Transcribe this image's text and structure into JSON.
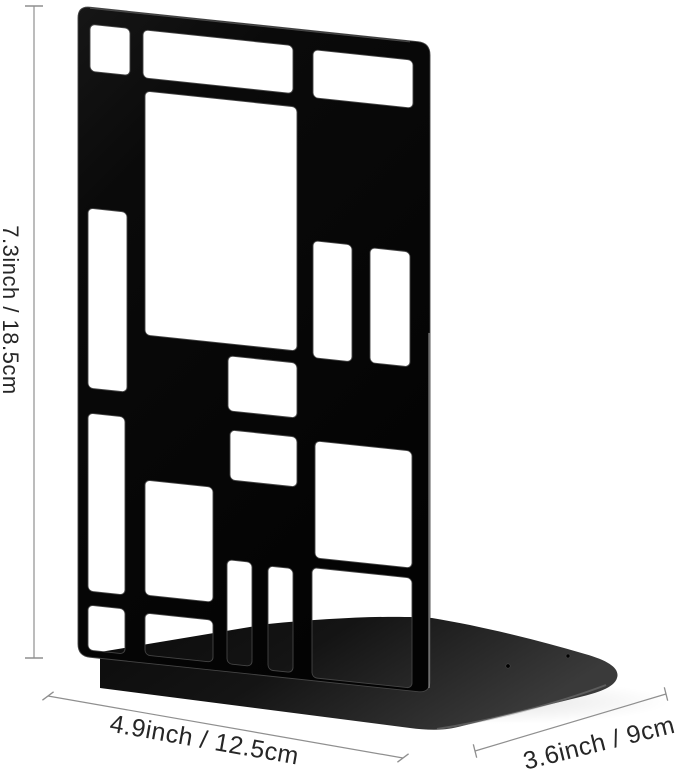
{
  "product": {
    "description": "Black metal bookend with Mondrian-style rectangular grid cutouts standing on an L-shaped base plate"
  },
  "annotations": {
    "height_label": "7.3inch / 18.5cm",
    "width_label": "4.9inch / 12.5cm",
    "depth_label": "3.6inch / 9cm"
  },
  "colors": {
    "panel_black": "#0a0a0a",
    "panel_edge": "#454545",
    "base_dark": "#0d0d0d",
    "base_sheen": "#3a3a3a",
    "dimension_line": "#8f8f8f",
    "label_text": "#262626",
    "background": "#ffffff"
  }
}
